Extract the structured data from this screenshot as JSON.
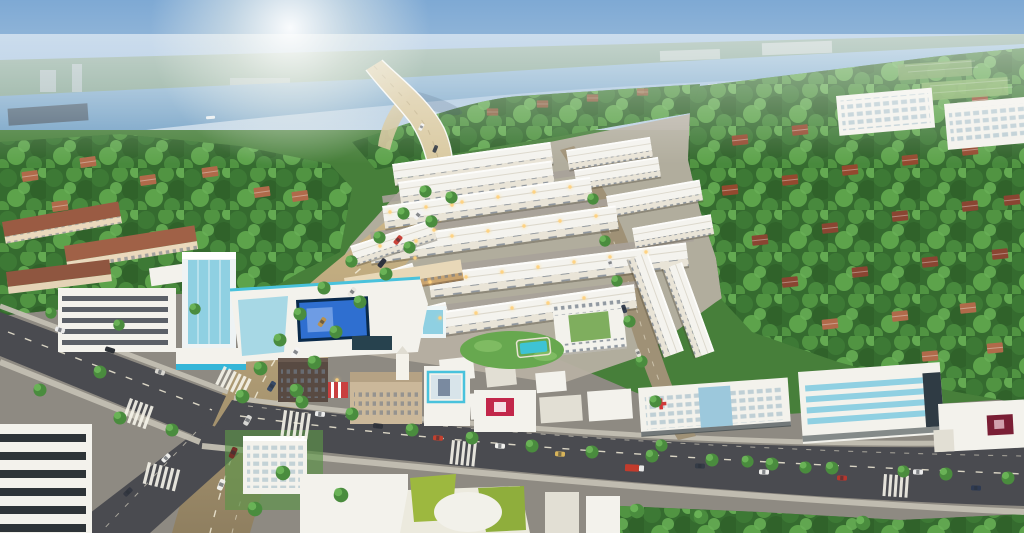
{
  "scene": {
    "title": "Aerial perspective rendering — riverside township development",
    "description": "Bird's-eye 3D render of a planned township: a curved flyover bridge crosses a hazy river under a morning sun; a sunlit main avenue leads to a crossroads; rows of white shophouses surround a central pool park; dense green forest with red-roofed villas, a school campus, offices, a glass tower, a mall with a blue LED screen, a hospital block and apartment slabs by sports fields frame the scene.",
    "time_of_day": "hazy morning sun",
    "colors": {
      "sky_top": "#7ea9d4",
      "sky_mid": "#a9c5de",
      "sky_horizon": "#dde8ee",
      "sun_glow": "#ffffff",
      "far_bank": "#7a9c80",
      "river_near": "#6d9cc2",
      "river_far": "#93b9d4",
      "forest_base": "#356b2f",
      "foliage_mid": "#549844",
      "roof_red": "#94492f",
      "road_sunlit": "#d3bc8c",
      "road_sunlit_low": "#8f7f60",
      "road_asphalt": "#4a4b50",
      "road_marking": "#f5f2e6",
      "building_white": "#f3f2ec",
      "glass_cyan": "#8fd0e2",
      "screen_blue": "#2f6fd0",
      "sign_red": "#c2274a",
      "sign_dark_red": "#7a1f35",
      "park_green": "#67a84f",
      "pool_cyan": "#3ec3d4",
      "light_warm": "#ffd27e"
    },
    "landmarks": [
      {
        "id": "river",
        "label": "River with tree-lined far bank"
      },
      {
        "id": "bridge",
        "label": "Curved flyover bridge over the river"
      },
      {
        "id": "main-avenue",
        "label": "Sunlit main avenue from bridge to crossroads"
      },
      {
        "id": "boulevard",
        "label": "Asphalt boulevard with lane markings and traffic"
      },
      {
        "id": "township-rows",
        "label": "Rows of white shophouses"
      },
      {
        "id": "central-park",
        "label": "Central park with swimming pool"
      },
      {
        "id": "apartment-court",
        "label": "Courtyard apartment block"
      },
      {
        "id": "mall",
        "label": "Shopping mall with blue LED billboard"
      },
      {
        "id": "glass-tower",
        "label": "Cyan glass office tower"
      },
      {
        "id": "striped-office",
        "label": "Office building with dark window bands"
      },
      {
        "id": "school",
        "label": "School campus with terracotta roofs"
      },
      {
        "id": "hospital",
        "label": "White hospital block with red cross"
      },
      {
        "id": "glass-band-building",
        "label": "Office block with cyan glass bands"
      },
      {
        "id": "apartment-slabs",
        "label": "Apartment slabs beside sports fields"
      },
      {
        "id": "forest",
        "label": "Dense forest with red-roofed villas"
      }
    ]
  }
}
